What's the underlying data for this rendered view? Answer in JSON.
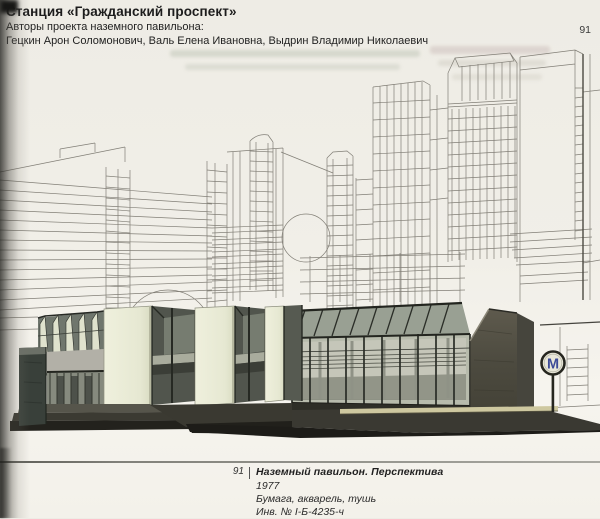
{
  "header": {
    "title": "Станция «Гражданский проспект»",
    "authors_label": "Авторы проекта наземного павильона:",
    "authors": "Гецкин Арон Соломонович, Валь Елена Ивановна, Выдрин Владимир Николаевич"
  },
  "page_number": "91",
  "caption": {
    "figure_number": "91",
    "title": "Наземный павильон. Перспектива",
    "year": "1977",
    "medium": "Бумага, акварель, тушь",
    "inventory_number": "Инв. № I-Б-4235-ч"
  },
  "artwork": {
    "metro_sign_letter": "М",
    "colors": {
      "paper": "#f1efe8",
      "ink_line": "#827f77",
      "pavilion_cream": "#eaebd7",
      "glass_dark": "#51554d",
      "hall_glass": "#b7bbac",
      "concrete_dark": "#504e44",
      "ground_dark": "#34332c",
      "curb_yellow": "#cec8a0",
      "metro_blue": "#3d4b97"
    }
  }
}
